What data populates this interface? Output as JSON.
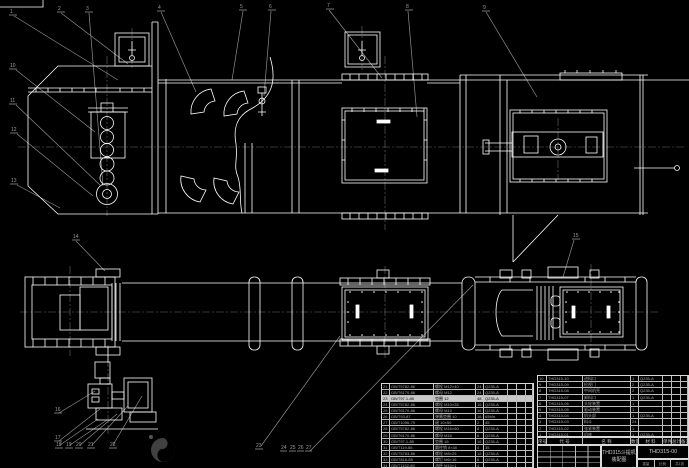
{
  "title_block": {
    "product_name": "THD315斗提机",
    "drawing_type": "装配图",
    "drawing_no": "THD315-00",
    "extra": [
      "重量",
      "比例",
      "共1张"
    ]
  },
  "bom_header_rows": [
    [
      "序号",
      "代 号",
      "名 称",
      "数量",
      "材 料",
      "单件",
      "总计",
      "备注"
    ]
  ],
  "bom_right": {
    "rows": [
      [
        "10",
        "THD315-10",
        "进料口",
        "1",
        "Q235-A",
        "",
        "",
        ""
      ],
      [
        "9",
        "THD315-09",
        "检视门",
        "2",
        "Q235-A",
        "",
        "",
        ""
      ],
      [
        "8",
        "THD315-08",
        "中间机壳",
        "2",
        "Q235-A",
        "",
        "",
        ""
      ],
      [
        "7",
        "THD315-07",
        "卸料口",
        "1",
        "Q235-A",
        "",
        "",
        ""
      ],
      [
        "6",
        "THD315-06",
        "头轮装置",
        "1",
        "",
        "",
        "",
        ""
      ],
      [
        "5",
        "THD315-05",
        "驱动装置",
        "1",
        "",
        "",
        "",
        ""
      ],
      [
        "4",
        "THD315-04",
        "机头部",
        "1",
        "Q235-A",
        "",
        "",
        ""
      ],
      [
        "3",
        "THD315-03",
        "料斗",
        "24",
        "",
        "",
        "",
        ""
      ],
      [
        "2",
        "THD315-02",
        "张紧装置",
        "1",
        "",
        "",
        "",
        ""
      ],
      [
        "1",
        "THD315-01",
        "机座",
        "1",
        "Q235-A",
        "",
        "",
        ""
      ]
    ]
  },
  "bom_left": {
    "rows": [
      [
        "21",
        "GB/T5782-86",
        "螺栓 M12×40",
        "24",
        "Q235-A",
        "",
        "",
        ""
      ],
      [
        "22",
        "GB/T6170-86",
        "螺母 M12",
        "24",
        "Q235-A",
        "",
        "",
        ""
      ],
      [
        "23",
        "GB/T97.1-85",
        "垫圈 12",
        "48",
        "Q235-A",
        "",
        "",
        ""
      ],
      [
        "24",
        "GB/T5782-86",
        "螺栓 M10×35",
        "16",
        "Q235-A",
        "",
        "",
        ""
      ],
      [
        "25",
        "GB/T6170-86",
        "螺母 M10",
        "16",
        "Q235-A",
        "",
        "",
        ""
      ],
      [
        "26",
        "GB/T93-87",
        "弹簧垫圈 10",
        "16",
        "65Mn",
        "",
        "",
        ""
      ],
      [
        "27",
        "GB/T1096-79",
        "键 10×50",
        "2",
        "45",
        "",
        "",
        ""
      ],
      [
        "28",
        "GB/T5782-86",
        "螺栓 M16×60",
        "8",
        "Q235-A",
        "",
        "",
        ""
      ],
      [
        "29",
        "GB/T6170-86",
        "螺母 M16",
        "8",
        "Q235-A",
        "",
        "",
        ""
      ],
      [
        "30",
        "GB/T97.1-85",
        "垫圈 16",
        "16",
        "Q235-A",
        "",
        "",
        ""
      ],
      [
        "31",
        "GB/T119-86",
        "圆柱销 8×30",
        "4",
        "35",
        "",
        "",
        ""
      ],
      [
        "32",
        "GB/T5783-86",
        "螺栓 M8×25",
        "12",
        "Q235-A",
        "",
        "",
        ""
      ],
      [
        "33",
        "GB/T818-85",
        "螺钉 M6×16",
        "8",
        "Q235-A",
        "",
        "",
        ""
      ],
      [
        "34",
        "GB/T1152-89",
        "油杯 M10×1",
        "4",
        "",
        "",
        "",
        ""
      ]
    ]
  },
  "callouts": [
    "1",
    "2",
    "3",
    "4",
    "5",
    "6",
    "7",
    "8",
    "9",
    "10",
    "11",
    "12",
    "13",
    "14",
    "15",
    "16",
    "17",
    "18",
    "19",
    "20",
    "21",
    "22",
    "23",
    "24",
    "25",
    "26",
    "27"
  ],
  "colors": {
    "background": "#000000",
    "geometry_line": "#ffffff",
    "leader_line": "#8f8f8f",
    "centerline": "#6a6a6a",
    "table_line": "#d0d0d0",
    "highlight_row": "#c9c9c9"
  }
}
